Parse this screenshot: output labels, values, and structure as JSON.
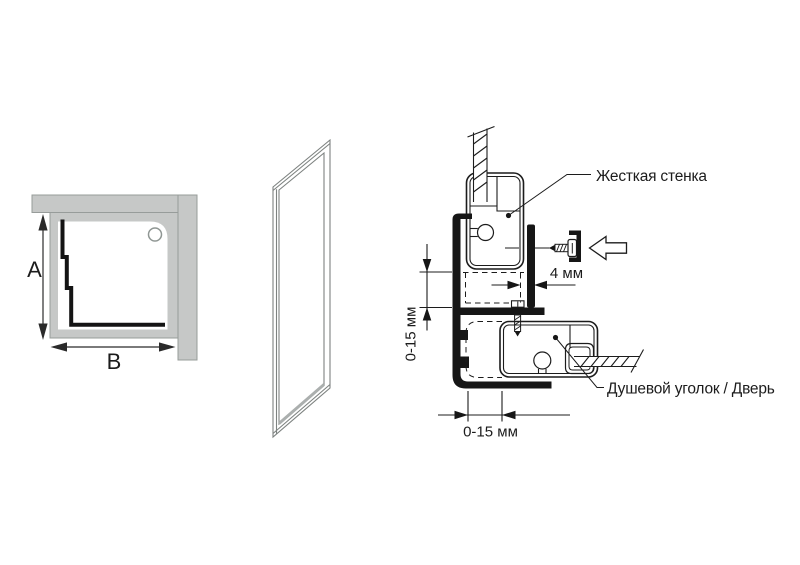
{
  "plan_view": {
    "height_dim_label": "A",
    "width_dim_label": "B"
  },
  "section_view": {
    "fixed_wall_label": "Жесткая стенка",
    "door_label": "Душевой уголок / Дверь",
    "wall_gap_dim": "4 мм",
    "vertical_adjust_dim": "0-15 мм",
    "horizontal_adjust_dim": "0-15 мм"
  },
  "colors": {
    "background": "#ffffff",
    "wall_fill": "#c6c8c7",
    "line": "#1c1c1c",
    "panel_line": "#7d8280"
  }
}
